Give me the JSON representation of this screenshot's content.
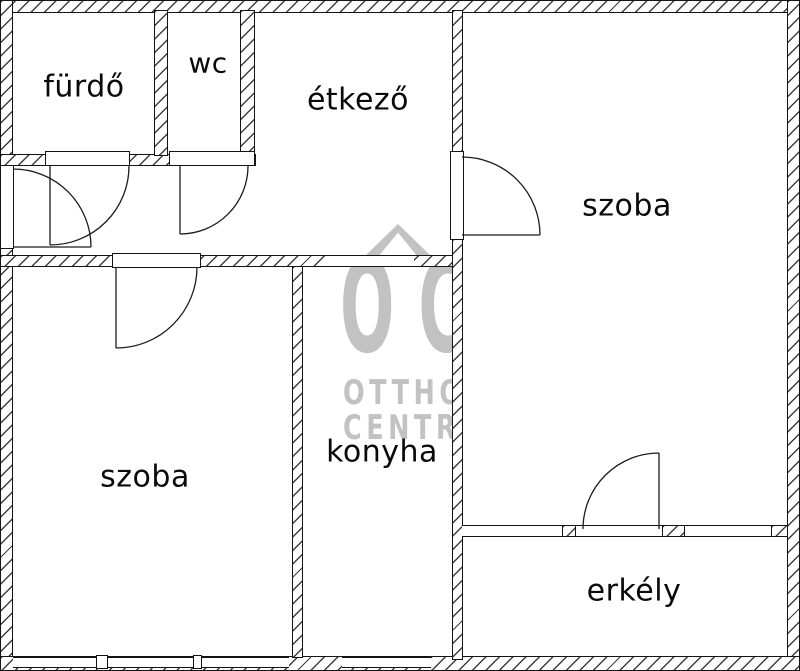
{
  "floorplan": {
    "rooms": {
      "bathroom": {
        "label": "fürdő"
      },
      "wc": {
        "label": "wc"
      },
      "dining": {
        "label": "étkező"
      },
      "room_right": {
        "label": "szoba"
      },
      "room_left": {
        "label": "szoba"
      },
      "kitchen": {
        "label": "konyha"
      },
      "balcony": {
        "label": "erkély"
      }
    },
    "watermark": {
      "logo": "OC",
      "line1": "OTTHON",
      "line2": "CENTRUM"
    },
    "colors": {
      "background": "#ffffff",
      "wall_outline": "#141414",
      "wall_hatch": "#3f3f3f",
      "watermark_gray": "#c2c2c2",
      "label_text": "#0a0a0a"
    }
  }
}
